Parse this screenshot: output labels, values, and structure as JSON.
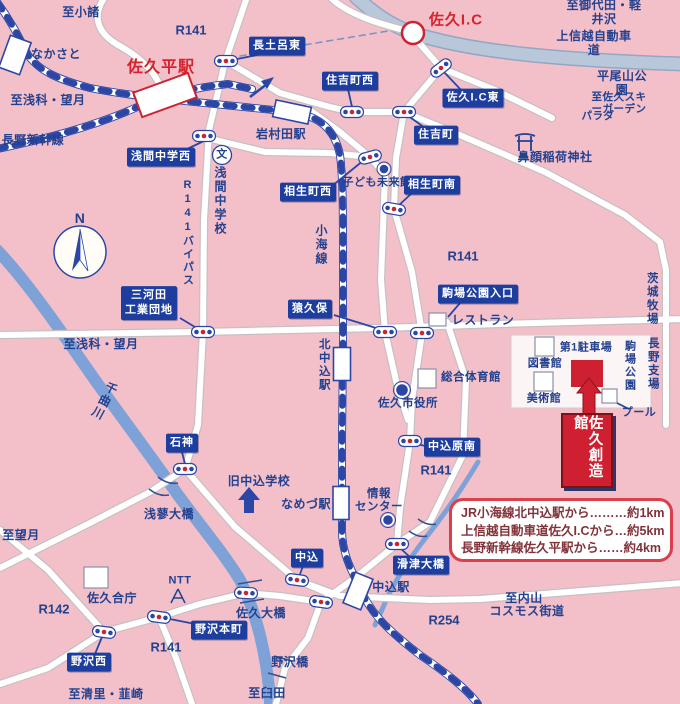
{
  "colors": {
    "background_pink": "#f3c0ca",
    "road_white": "#ffffff",
    "road_casing": "#c8bfc2",
    "rail_blue": "#2b46a5",
    "river_blue": "#7ea2d8",
    "highway_fill": "#b9c7da",
    "highway_casing": "#93a7c4",
    "sign_blue": "#1d3e9e",
    "accent_red": "#ce2030"
  },
  "destination": {
    "name": "佐久創造館"
  },
  "info_box": {
    "lines": [
      "JR小海線北中込駅から………約1km",
      "上信越自動車道佐久I.Cから…約5km",
      "長野新幹線佐久平駅から……約4km"
    ]
  },
  "labels": {
    "red": [
      {
        "t": "佐久平駅",
        "x": 161,
        "y": 68,
        "s": 16
      },
      {
        "t": "佐久I.C",
        "x": 456,
        "y": 20,
        "s": 15
      }
    ],
    "plain": [
      {
        "t": "至小諸",
        "x": 81,
        "y": 13
      },
      {
        "t": "R141",
        "x": 191,
        "y": 31,
        "k": "route"
      },
      {
        "t": "なかさと",
        "x": 56,
        "y": 55
      },
      {
        "t": "至浅科・望月",
        "x": 48,
        "y": 101
      },
      {
        "t": "長野新幹線",
        "x": 33,
        "y": 141
      },
      {
        "t": "至御代田・軽井沢",
        "x": 604,
        "y": 13
      },
      {
        "t": "上信越自動車道",
        "x": 594,
        "y": 44
      },
      {
        "t": "平尾山公園",
        "x": 622,
        "y": 84
      },
      {
        "t": "至佐久スキーガーデン",
        "x": 619,
        "y": 103,
        "s": 10.5
      },
      {
        "t": "パラダ",
        "x": 598,
        "y": 116,
        "s": 10.5
      },
      {
        "t": "鼻顔稲荷神社",
        "x": 555,
        "y": 158
      },
      {
        "t": "岩村田駅",
        "x": 281,
        "y": 135
      },
      {
        "t": "文",
        "x": 222,
        "y": 155,
        "s": 11
      },
      {
        "t": "子ども未来館",
        "x": 377,
        "y": 183,
        "s": 11
      },
      {
        "t": "R141",
        "x": 463,
        "y": 257,
        "k": "route"
      },
      {
        "t": "レストラン",
        "x": 483,
        "y": 321
      },
      {
        "t": "第1駐車場",
        "x": 586,
        "y": 348,
        "s": 11
      },
      {
        "t": "図書館",
        "x": 545,
        "y": 364,
        "s": 11
      },
      {
        "t": "美術館",
        "x": 544,
        "y": 399,
        "s": 11
      },
      {
        "t": "プール",
        "x": 639,
        "y": 413,
        "s": 11
      },
      {
        "t": "総合体育館",
        "x": 471,
        "y": 378,
        "s": 11.5
      },
      {
        "t": "佐久市役所",
        "x": 408,
        "y": 404,
        "s": 11.5
      },
      {
        "t": "至浅科・望月",
        "x": 101,
        "y": 345
      },
      {
        "t": "R141",
        "x": 436,
        "y": 471,
        "k": "route"
      },
      {
        "t": "旧中込学校",
        "x": 259,
        "y": 482
      },
      {
        "t": "なめづ駅",
        "x": 306,
        "y": 505
      },
      {
        "t": "情報\nセンター",
        "x": 379,
        "y": 501,
        "s": 11.5
      },
      {
        "t": "至望月",
        "x": 21,
        "y": 536
      },
      {
        "t": "浅蓼大橋",
        "x": 169,
        "y": 515
      },
      {
        "t": "中込駅",
        "x": 391,
        "y": 588
      },
      {
        "t": "佐久大橋",
        "x": 261,
        "y": 614
      },
      {
        "t": "NTT",
        "x": 180,
        "y": 581,
        "s": 11
      },
      {
        "t": "佐久合庁",
        "x": 112,
        "y": 599
      },
      {
        "t": "R142",
        "x": 54,
        "y": 610,
        "k": "route"
      },
      {
        "t": "R141",
        "x": 166,
        "y": 648,
        "k": "route"
      },
      {
        "t": "野沢橋",
        "x": 290,
        "y": 663
      },
      {
        "t": "至清里・韮崎",
        "x": 106,
        "y": 695
      },
      {
        "t": "至臼田",
        "x": 267,
        "y": 694
      },
      {
        "t": "至内山",
        "x": 524,
        "y": 599
      },
      {
        "t": "コスモス街道",
        "x": 527,
        "y": 612
      },
      {
        "t": "R254",
        "x": 444,
        "y": 621,
        "k": "route"
      },
      {
        "t": "N",
        "x": 80,
        "y": 218,
        "s": 14
      }
    ],
    "vertical": [
      {
        "t": "浅間中学校",
        "x": 220,
        "y": 201
      },
      {
        "t": "R141バイパス",
        "x": 187,
        "y": 233,
        "s": 11
      },
      {
        "t": "小海線",
        "x": 321,
        "y": 245
      },
      {
        "t": "北中込駅",
        "x": 323,
        "y": 365,
        "s": 11.5
      },
      {
        "t": "千曲川",
        "x": 104,
        "y": 401,
        "r": 28
      },
      {
        "t": "駒場公園",
        "x": 629,
        "y": 366,
        "s": 11
      },
      {
        "t": "茨城牧場",
        "x": 651,
        "y": 299,
        "s": 11.5
      },
      {
        "t": "長野支場",
        "x": 652,
        "y": 364,
        "s": 11.5
      }
    ],
    "signs": [
      {
        "t": "長土呂東",
        "x": 277,
        "y": 46
      },
      {
        "t": "住吉町西",
        "x": 350,
        "y": 81
      },
      {
        "t": "佐久I.C東",
        "x": 473,
        "y": 98
      },
      {
        "t": "住吉町",
        "x": 436,
        "y": 135
      },
      {
        "t": "相生町南",
        "x": 432,
        "y": 185
      },
      {
        "t": "相生町西",
        "x": 308,
        "y": 192
      },
      {
        "t": "浅間中学西",
        "x": 161,
        "y": 157
      },
      {
        "t": "三河田\n工業団地",
        "x": 149,
        "y": 303
      },
      {
        "t": "駒場公園入口",
        "x": 478,
        "y": 294
      },
      {
        "t": "猿久保",
        "x": 310,
        "y": 309
      },
      {
        "t": "中込原南",
        "x": 452,
        "y": 447
      },
      {
        "t": "石神",
        "x": 182,
        "y": 443
      },
      {
        "t": "中込",
        "x": 307,
        "y": 558
      },
      {
        "t": "滑津大橋",
        "x": 421,
        "y": 565
      },
      {
        "t": "野沢本町",
        "x": 219,
        "y": 630
      },
      {
        "t": "野沢西",
        "x": 89,
        "y": 662
      }
    ]
  },
  "signals": [
    [
      226,
      61,
      0
    ],
    [
      204,
      136,
      0
    ],
    [
      352,
      112,
      0
    ],
    [
      404,
      112,
      0
    ],
    [
      441,
      68,
      -38
    ],
    [
      370,
      157,
      -15
    ],
    [
      394,
      209,
      10
    ],
    [
      203,
      332,
      0
    ],
    [
      385,
      332,
      0
    ],
    [
      422,
      333,
      0
    ],
    [
      410,
      441,
      0
    ],
    [
      185,
      469,
      0
    ],
    [
      297,
      580,
      8
    ],
    [
      397,
      544,
      0
    ],
    [
      159,
      617,
      8
    ],
    [
      104,
      632,
      8
    ],
    [
      246,
      593,
      3
    ],
    [
      321,
      602,
      8
    ]
  ],
  "stations": [
    {
      "x": 15,
      "y": 55,
      "w": 22,
      "h": 34,
      "r": 20,
      "red": false
    },
    {
      "x": 165,
      "y": 95,
      "w": 58,
      "h": 26,
      "r": -20,
      "red": true
    },
    {
      "x": 292,
      "y": 112,
      "w": 36,
      "h": 17,
      "r": 12,
      "red": false
    },
    {
      "x": 342,
      "y": 364,
      "w": 17,
      "h": 33,
      "r": 0,
      "red": false
    },
    {
      "x": 341,
      "y": 503,
      "w": 16,
      "h": 33,
      "r": 0,
      "red": false
    },
    {
      "x": 358,
      "y": 591,
      "w": 19,
      "h": 33,
      "r": 22,
      "red": false
    }
  ],
  "poi_dots": [
    {
      "x": 384,
      "y": 169,
      "r": 5
    },
    {
      "x": 402,
      "y": 390,
      "r": 6.5
    },
    {
      "x": 388,
      "y": 520,
      "r": 5.5
    }
  ]
}
